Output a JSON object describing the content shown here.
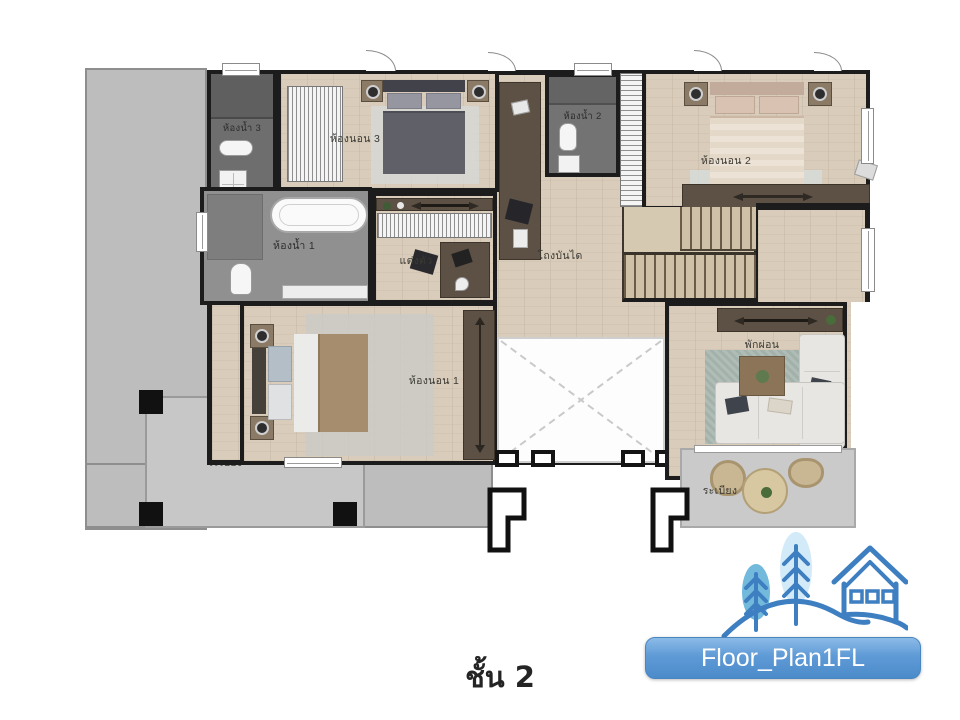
{
  "caption": "ชั้น 2",
  "button": {
    "label": "Floor_Plan1FL",
    "color": "#5b9bd5"
  },
  "logo": {
    "name": "house-and-trees-logo",
    "line_color": "#3e7fc1",
    "tree_front_color": "#72b9dc",
    "tree_back_color": "#d3eaf8"
  },
  "rooms": {
    "bathroom3": {
      "label": "ห้องน้ำ 3"
    },
    "bedroom3": {
      "label": "ห้องนอน 3"
    },
    "bathroom2": {
      "label": "ห้องน้ำ 2"
    },
    "bedroom2": {
      "label": "ห้องนอน 2"
    },
    "bathroom1": {
      "label": "ห้องน้ำ 1"
    },
    "dressing": {
      "label": "แต่งตัว"
    },
    "stair_hall": {
      "label": "โถงบันได"
    },
    "bedroom1": {
      "label": "ห้องนอน 1"
    },
    "lounge": {
      "label": "พักผ่อน"
    },
    "balcony_left": {
      "label": "ระเบียง"
    },
    "balcony_right": {
      "label": "ระเบียง"
    }
  }
}
